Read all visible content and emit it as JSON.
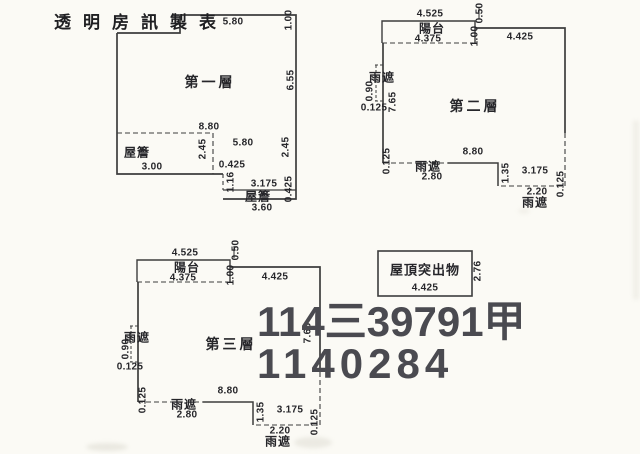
{
  "document_title": "透明房訊製表",
  "watermark": {
    "line1": "114三39791甲",
    "line2": "1140284"
  },
  "floor1": {
    "name": "第一層",
    "dims": {
      "top_width": "5.80",
      "right_top": "1.00",
      "right_upper": "6.55",
      "inner_width_upper": "8.80",
      "inner_width_lower": "5.80",
      "right_lower": "2.45",
      "eave_left_label": "屋簷",
      "eave_left_depth": "2.45",
      "eave_left_width": "3.00",
      "notch_offset": "0.425",
      "notch_height": "1.16",
      "ext_width": "3.175",
      "eave_right_label": "屋簷",
      "eave_right_depth": "0.425",
      "ext_bottom_width": "3.60"
    }
  },
  "floor2": {
    "name": "第二層",
    "dims": {
      "balcony_top_width": "4.525",
      "balcony_label": "陽台",
      "balcony_width": "4.375",
      "top_step": "0.50",
      "top_inset": "1.00",
      "top_width": "4.425",
      "canopy_left_label": "雨遮",
      "canopy_left_height": "0.90",
      "canopy_left_width": "0.125",
      "left_height": "7.65",
      "bottom_left_offset": "0.125",
      "canopy_bottom_label": "雨遮",
      "canopy_bottom_width": "2.80",
      "bottom_width": "8.80",
      "bottom_step_height": "1.35",
      "bottom_ext_width": "3.175",
      "canopy_right_width": "2.20",
      "canopy_right_label": "雨遮",
      "right_offset": "0.125"
    }
  },
  "floor3": {
    "name": "第三層",
    "dims": {
      "balcony_top_width": "4.525",
      "balcony_label": "陽台",
      "balcony_width": "4.375",
      "top_step": "0.50",
      "top_inset": "1.00",
      "top_width": "4.425",
      "canopy_left_label": "雨遮",
      "canopy_left_height": "0.90",
      "canopy_left_width": "0.125",
      "right_height": "7.65",
      "bottom_left_offset": "0.125",
      "canopy_bottom_label": "雨遮",
      "canopy_bottom_width": "2.80",
      "bottom_width": "8.80",
      "bottom_step_height": "1.35",
      "bottom_ext_width": "3.175",
      "canopy_right_width": "2.20",
      "canopy_right_label": "雨遮",
      "right_offset": "0.125"
    }
  },
  "roof": {
    "label": "屋頂突出物",
    "width": "4.425",
    "height": "2.76"
  }
}
